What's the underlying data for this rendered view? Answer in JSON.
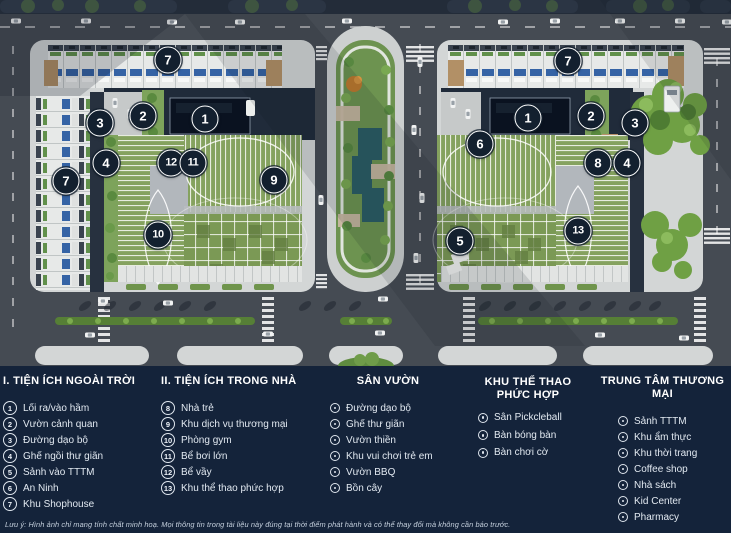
{
  "map": {
    "markers": [
      {
        "n": "7",
        "x": 168,
        "y": 60
      },
      {
        "n": "3",
        "x": 100,
        "y": 123
      },
      {
        "n": "2",
        "x": 143,
        "y": 116
      },
      {
        "n": "1",
        "x": 205,
        "y": 119
      },
      {
        "n": "4",
        "x": 106,
        "y": 163
      },
      {
        "n": "12",
        "x": 171,
        "y": 163
      },
      {
        "n": "11",
        "x": 193,
        "y": 163
      },
      {
        "n": "9",
        "x": 274,
        "y": 180
      },
      {
        "n": "7",
        "x": 66,
        "y": 181
      },
      {
        "n": "10",
        "x": 158,
        "y": 235
      },
      {
        "n": "7",
        "x": 568,
        "y": 61
      },
      {
        "n": "1",
        "x": 528,
        "y": 118
      },
      {
        "n": "2",
        "x": 591,
        "y": 116
      },
      {
        "n": "3",
        "x": 635,
        "y": 123
      },
      {
        "n": "6",
        "x": 480,
        "y": 144
      },
      {
        "n": "8",
        "x": 598,
        "y": 163
      },
      {
        "n": "4",
        "x": 627,
        "y": 163
      },
      {
        "n": "5",
        "x": 460,
        "y": 241
      },
      {
        "n": "13",
        "x": 578,
        "y": 231
      }
    ],
    "colors": {
      "marker_bg": "#13202f",
      "road": "#454b53",
      "roof_green": "#85a25f",
      "water": "#2a5c65",
      "block": "#d3d6d6"
    }
  },
  "legend": {
    "panel_bg": "#14233a",
    "columns": [
      {
        "id": "outdoor",
        "style": "numbered",
        "title": "I. TIỆN ÍCH NGOÀI TRỜI",
        "title_lines": [
          "I. TIỆN ÍCH NGOÀI TRỜI"
        ],
        "items": [
          {
            "num": "1",
            "label": "Lối ra/vào hầm"
          },
          {
            "num": "2",
            "label": "Vườn cảnh quan"
          },
          {
            "num": "3",
            "label": "Đường dạo bộ"
          },
          {
            "num": "4",
            "label": "Ghế ngồi thư giãn"
          },
          {
            "num": "5",
            "label": "Sảnh vào TTTM"
          },
          {
            "num": "6",
            "label": "An Ninh"
          },
          {
            "num": "7",
            "label": "Khu Shophouse"
          }
        ]
      },
      {
        "id": "indoor",
        "style": "numbered",
        "title": "II. TIỆN ÍCH TRONG NHÀ",
        "title_lines": [
          "II. TIỆN ÍCH TRONG NHÀ"
        ],
        "items": [
          {
            "num": "8",
            "label": "Nhà trẻ"
          },
          {
            "num": "9",
            "label": "Khu dịch vụ thương mại"
          },
          {
            "num": "10",
            "label": "Phòng gym"
          },
          {
            "num": "11",
            "label": "Bể bơi lớn"
          },
          {
            "num": "12",
            "label": "Bể vầy"
          },
          {
            "num": "13",
            "label": "Khu thể thao phức hợp"
          }
        ]
      },
      {
        "id": "garden",
        "style": "dot",
        "title": "SÂN VƯỜN",
        "title_lines": [
          "SÂN VƯỜN"
        ],
        "items": [
          {
            "label": "Đường dạo bộ"
          },
          {
            "label": "Ghế thư giãn"
          },
          {
            "label": "Vườn thiền"
          },
          {
            "label": "Khu vui chơi trẻ em"
          },
          {
            "label": "Vườn BBQ"
          },
          {
            "label": "Bồn cây"
          }
        ]
      },
      {
        "id": "sports",
        "style": "dot",
        "title": "KHU THỂ THAO PHỨC HỢP",
        "title_lines": [
          "KHU THỂ THAO",
          "PHỨC HỢP"
        ],
        "items": [
          {
            "label": "Sân Pickcleball"
          },
          {
            "label": "Bàn bóng bàn"
          },
          {
            "label": "Bàn chơi cờ"
          }
        ]
      },
      {
        "id": "mall",
        "style": "dot",
        "title": "TRUNG TÂM THƯƠNG MẠI",
        "title_lines": [
          "TRUNG TÂM THƯƠNG MẠI"
        ],
        "items": [
          {
            "label": "Sảnh TTTM"
          },
          {
            "label": "Khu ẩm thực"
          },
          {
            "label": "Khu thời trang"
          },
          {
            "label": "Coffee shop"
          },
          {
            "label": "Nhà sách"
          },
          {
            "label": "Kid Center"
          },
          {
            "label": "Pharmacy"
          }
        ]
      }
    ]
  },
  "footnote": "Lưu ý: Hình ảnh chỉ mang tính chất minh hoạ. Mọi thông tin trong tài liệu này đúng tại thời điểm phát hành và có thể thay đổi mà không cần báo trước."
}
